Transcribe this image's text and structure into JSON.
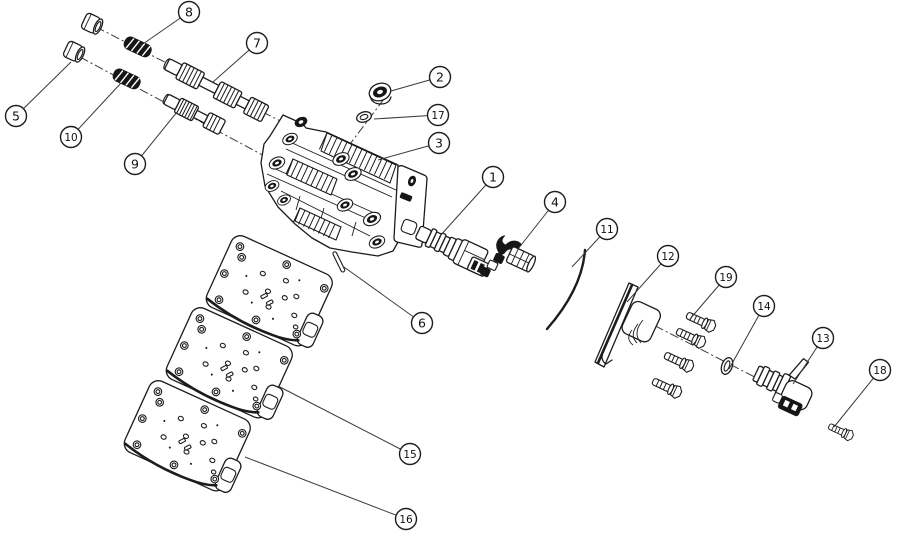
{
  "canvas": {
    "width": 900,
    "height": 539,
    "background": "#ffffff",
    "line_color": "#1c1c1c"
  },
  "callout_style": {
    "radius": 10.5,
    "fill": "#ffffff",
    "stroke": "#1c1c1c",
    "font_size_single": 12.5,
    "font_size_double": 10.5
  },
  "callouts": [
    {
      "label": "8",
      "cx": 189,
      "cy": 12,
      "tx": 140,
      "ty": 46
    },
    {
      "label": "7",
      "cx": 257,
      "cy": 43,
      "tx": 213,
      "ty": 82
    },
    {
      "label": "5",
      "cx": 16,
      "cy": 116,
      "tx": 71,
      "ty": 62
    },
    {
      "label": "10",
      "cx": 71,
      "cy": 137,
      "tx": 121,
      "ty": 83
    },
    {
      "label": "9",
      "cx": 135,
      "cy": 164,
      "tx": 177,
      "ty": 112
    },
    {
      "label": "2",
      "cx": 440,
      "cy": 77,
      "tx": 391,
      "ty": 91
    },
    {
      "label": "17",
      "cx": 438,
      "cy": 115,
      "tx": 374,
      "ty": 119
    },
    {
      "label": "3",
      "cx": 439,
      "cy": 143,
      "tx": 378,
      "ty": 160
    },
    {
      "label": "1",
      "cx": 493,
      "cy": 177,
      "tx": 440,
      "ty": 236
    },
    {
      "label": "4",
      "cx": 555,
      "cy": 202,
      "tx": 518,
      "ty": 249
    },
    {
      "label": "11",
      "cx": 607,
      "cy": 229,
      "tx": 572,
      "ty": 267
    },
    {
      "label": "6",
      "cx": 422,
      "cy": 323,
      "tx": 344,
      "ty": 267
    },
    {
      "label": "12",
      "cx": 668,
      "cy": 256,
      "tx": 627,
      "ty": 302
    },
    {
      "label": "19",
      "cx": 726,
      "cy": 277,
      "tx": 690,
      "ty": 319
    },
    {
      "label": "14",
      "cx": 764,
      "cy": 306,
      "tx": 729,
      "ty": 369
    },
    {
      "label": "13",
      "cx": 823,
      "cy": 338,
      "tx": 793,
      "ty": 384
    },
    {
      "label": "18",
      "cx": 880,
      "cy": 370,
      "tx": 834,
      "ty": 427
    },
    {
      "label": "15",
      "cx": 410,
      "cy": 454,
      "tx": 278,
      "ty": 386
    },
    {
      "label": "16",
      "cx": 406,
      "cy": 519,
      "tx": 245,
      "ty": 457
    }
  ]
}
